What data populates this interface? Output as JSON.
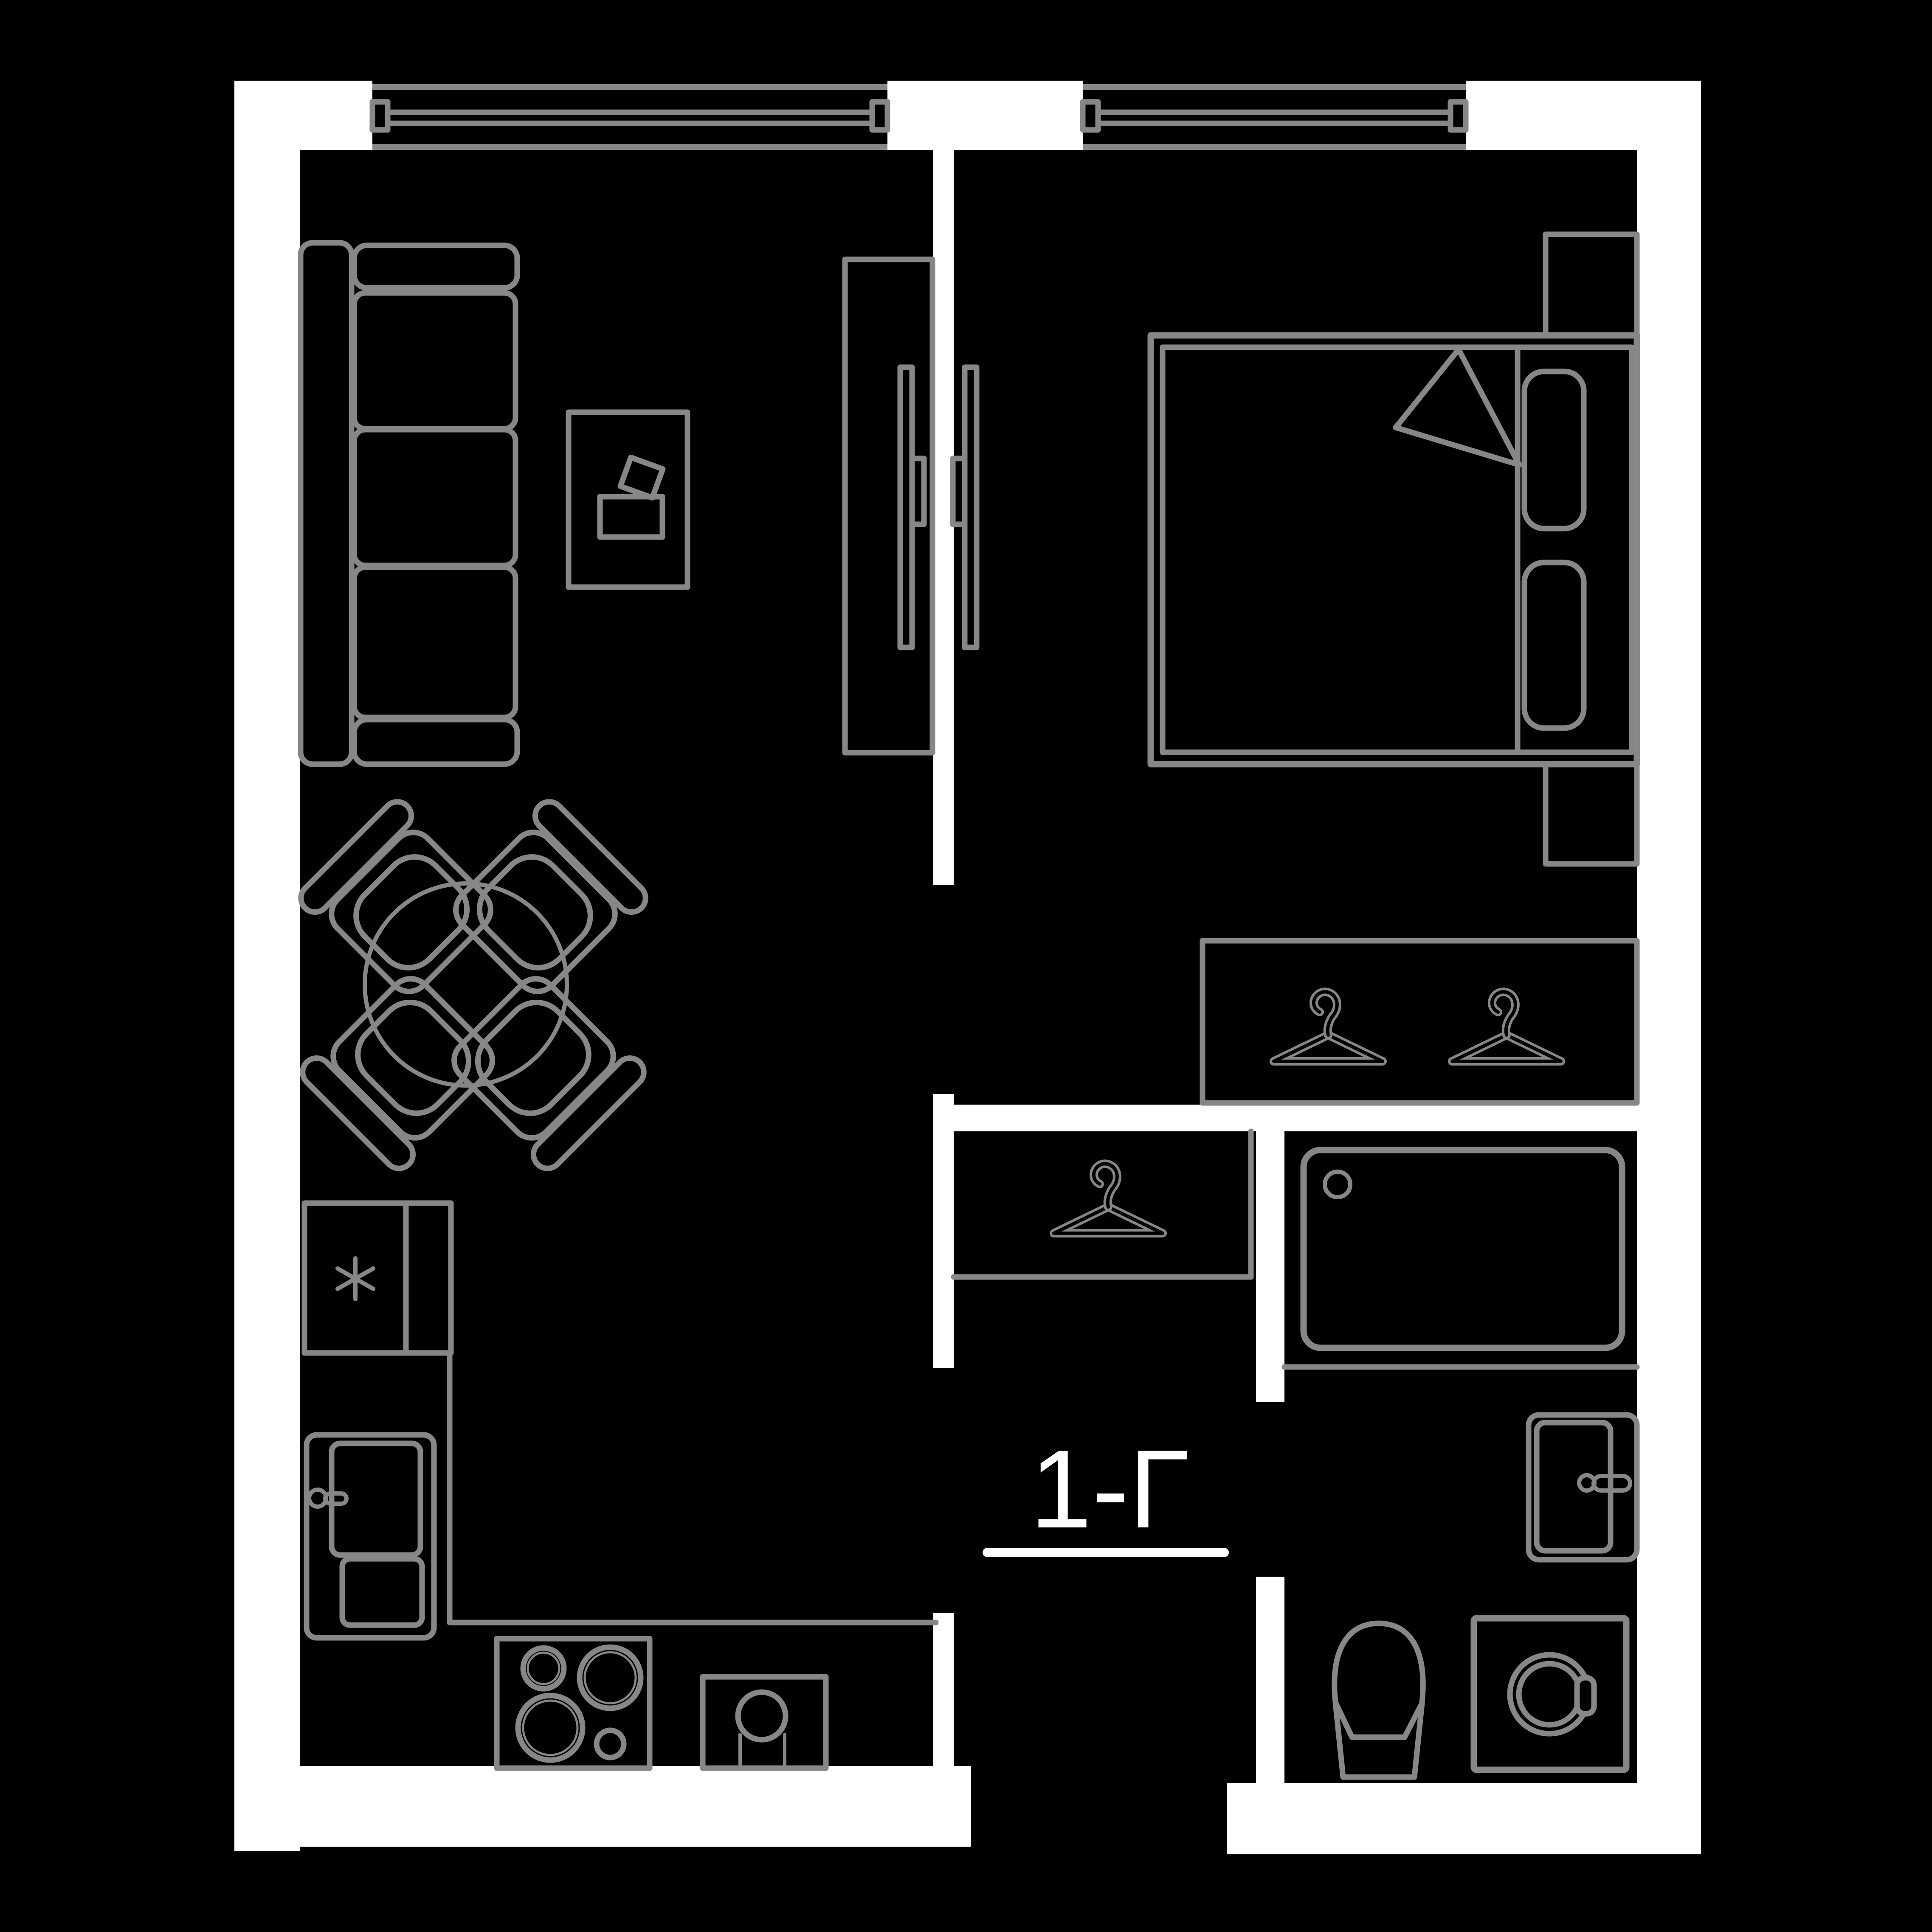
{
  "plan": {
    "unit_label": "1-Г",
    "colors": {
      "background": "#000000",
      "walls": "#ffffff",
      "furniture_outline": "#878787",
      "label_text": "#ffffff"
    },
    "rooms": [
      {
        "name": "living-room-with-kitchen",
        "furniture": [
          "sofa",
          "coffee-table",
          "tv-console",
          "wall-tv",
          "round-dining-table",
          "dining-chair",
          "dining-chair",
          "dining-chair",
          "dining-chair",
          "fridge-niche-with-asterisk",
          "kitchen-sink-unit",
          "counter",
          "cooktop",
          "round-sink"
        ]
      },
      {
        "name": "bedroom",
        "furniture": [
          "double-bed",
          "pillow",
          "pillow",
          "blanket",
          "nightstand",
          "nightstand",
          "wall-tv",
          "wardrobe-with-two-hangers"
        ]
      },
      {
        "name": "hallway",
        "furniture": [
          "closet-with-hanger"
        ]
      },
      {
        "name": "bathroom",
        "furniture": [
          "bathtub",
          "washbasin",
          "toilet",
          "washing-machine"
        ]
      }
    ],
    "windows": 2,
    "door_openings": [
      "bedroom",
      "hallway",
      "bathroom",
      "entrance"
    ]
  }
}
